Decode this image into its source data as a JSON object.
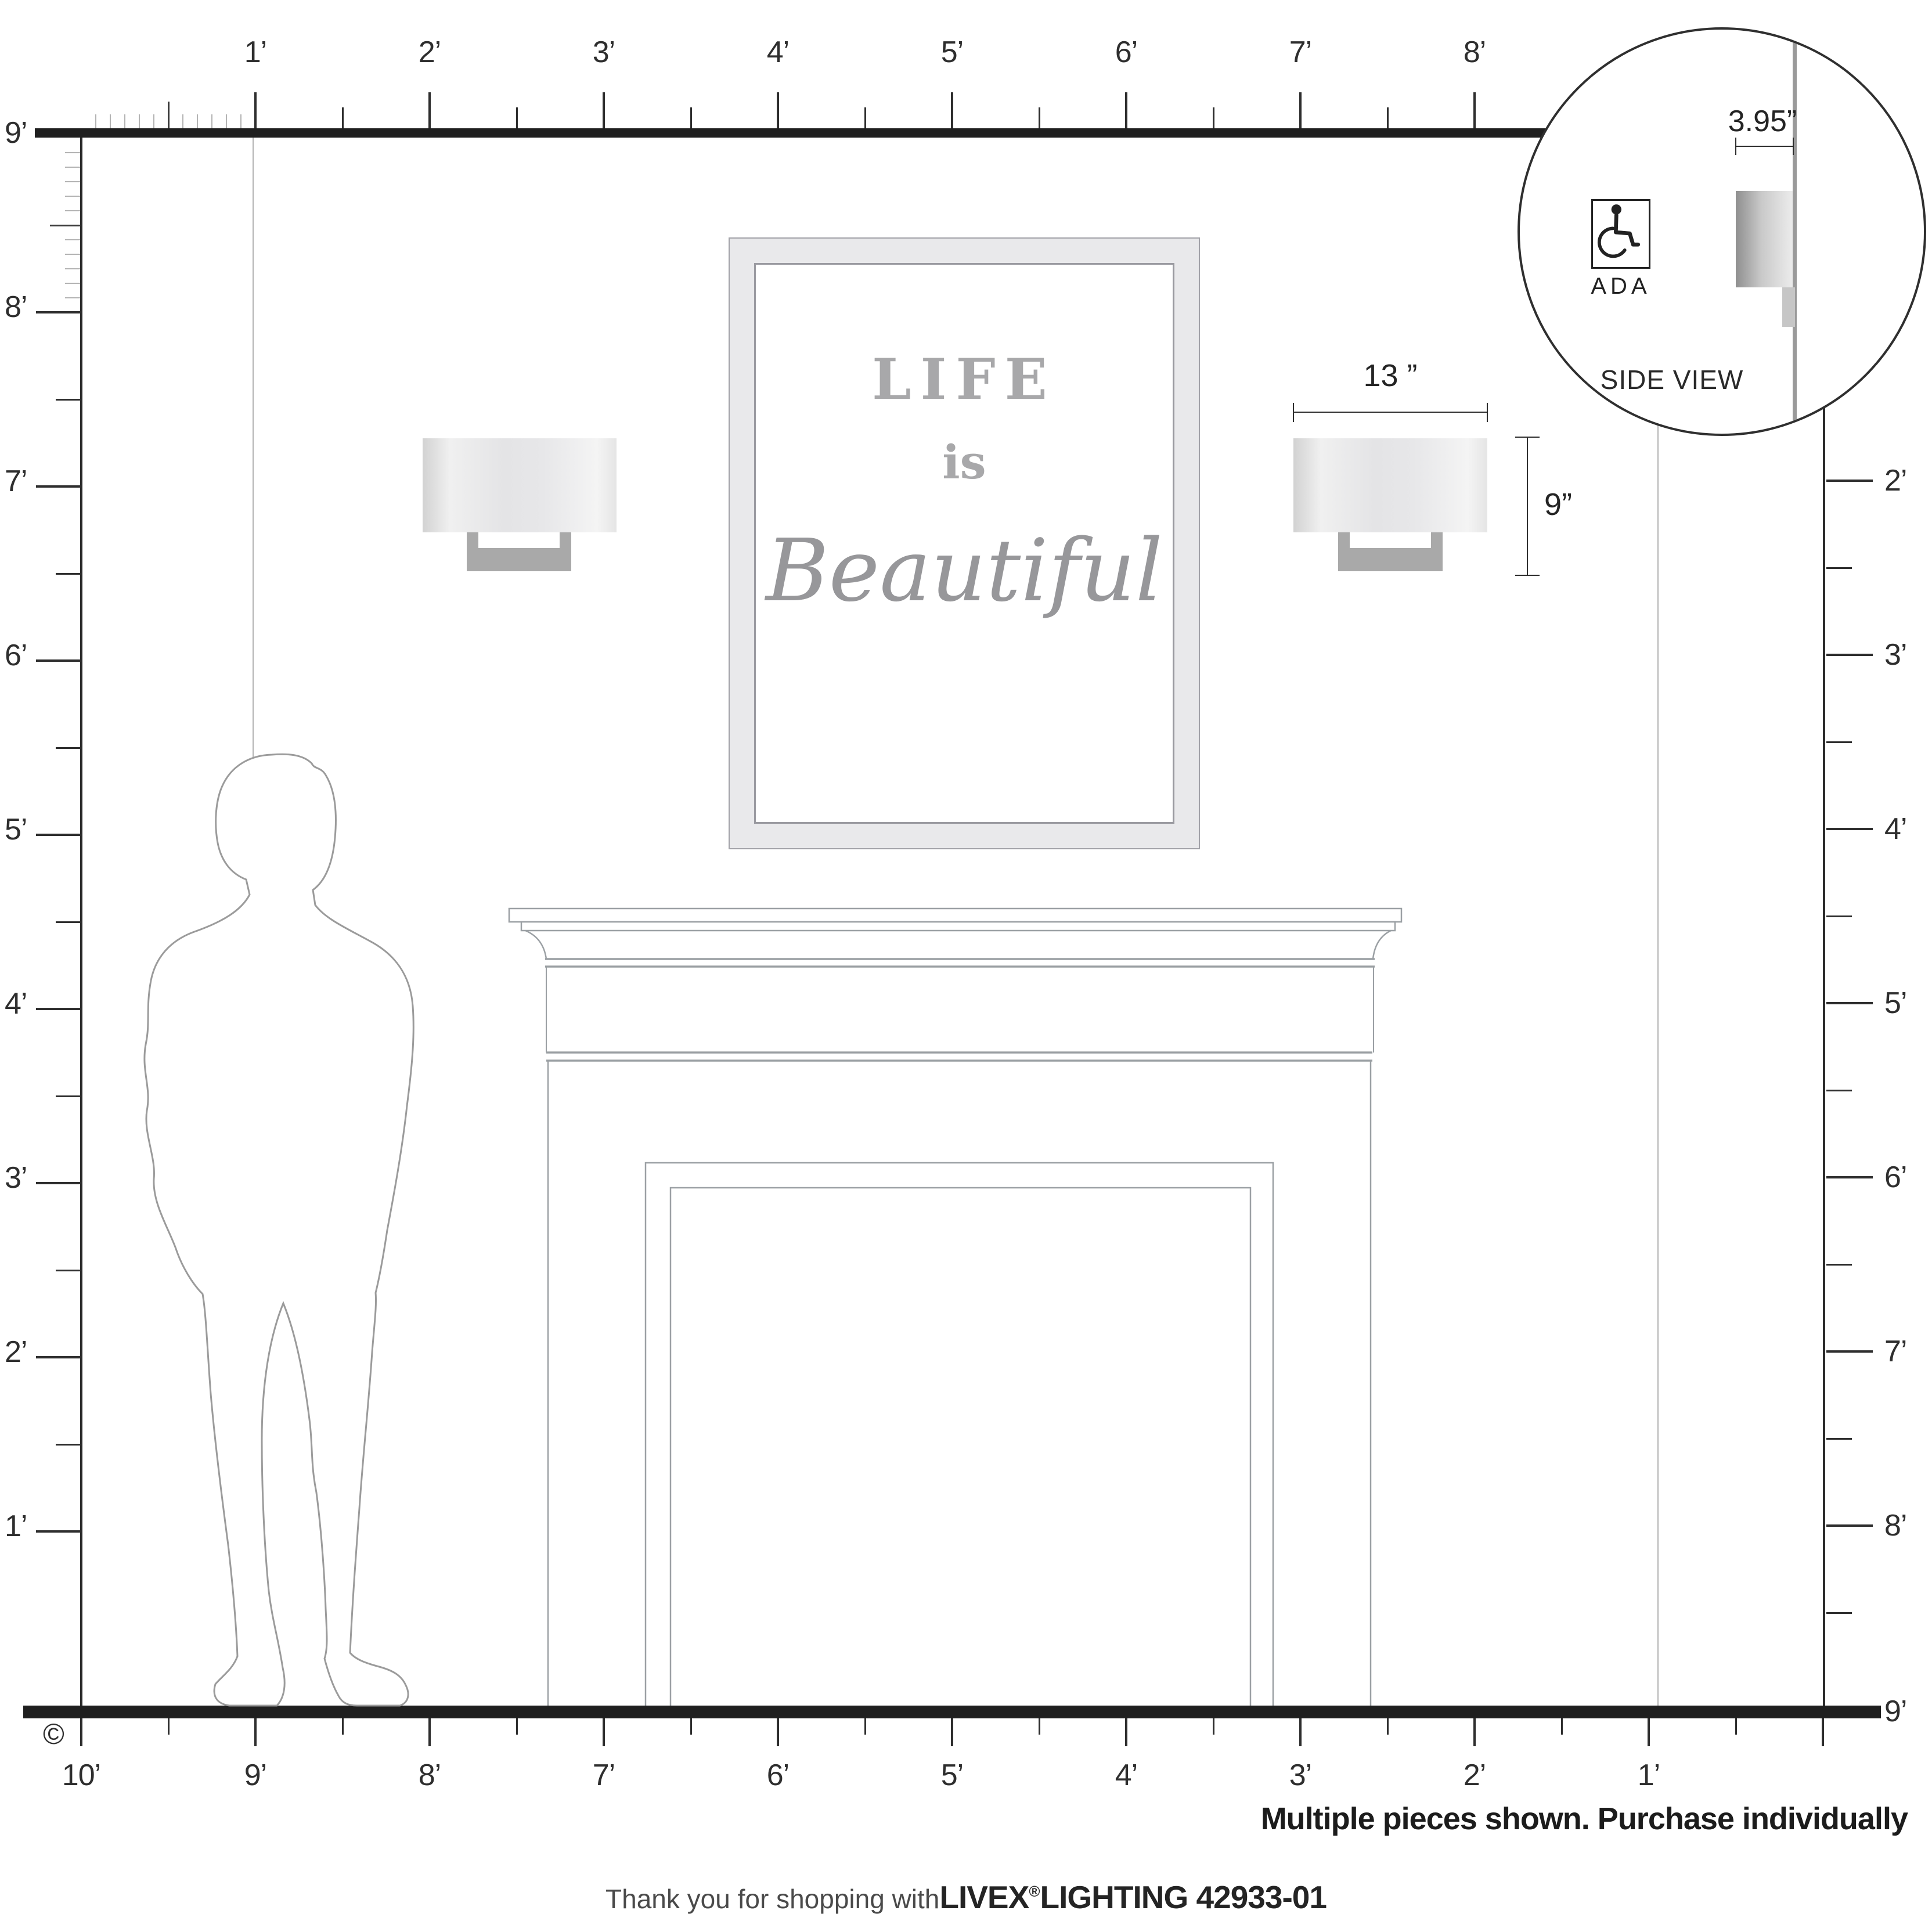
{
  "rulers": {
    "top": {
      "labels": [
        "1’",
        "2’",
        "3’",
        "4’",
        "5’",
        "6’",
        "7’",
        "8’"
      ]
    },
    "left": {
      "labels": [
        "9’",
        "8’",
        "7’",
        "6’",
        "5’",
        "4’",
        "3’",
        "2’",
        "1’"
      ]
    },
    "right": {
      "labels": [
        "2’",
        "3’",
        "4’",
        "5’",
        "6’",
        "7’",
        "8’",
        "9’"
      ]
    },
    "bottom": {
      "labels": [
        "10’",
        "9’",
        "8’",
        "7’",
        "6’",
        "5’",
        "4’",
        "3’",
        "2’",
        "1’"
      ]
    }
  },
  "artwork": {
    "line1": "LIFE",
    "line2": "is",
    "line3": "Beautiful"
  },
  "sconce": {
    "width_label": "13 ”",
    "height_label": "9”"
  },
  "inset": {
    "depth_label": "3.95”",
    "ada_label": "ADA",
    "caption": "SIDE VIEW"
  },
  "notes": {
    "purchase": "Multiple pieces shown. Purchase individually"
  },
  "footer": {
    "prefix": "Thank you for shopping with ",
    "brand": "LIVEX",
    "reg": "®",
    "suffix": " LIGHTING 42933-01"
  },
  "page": {
    "copyright": "©"
  },
  "colors": {
    "bar": "#1f1f1f",
    "outline_gray": "#9ba0a4",
    "silhouette_gray": "#9b9b9b",
    "bracket_gray": "#a9a9a9"
  }
}
